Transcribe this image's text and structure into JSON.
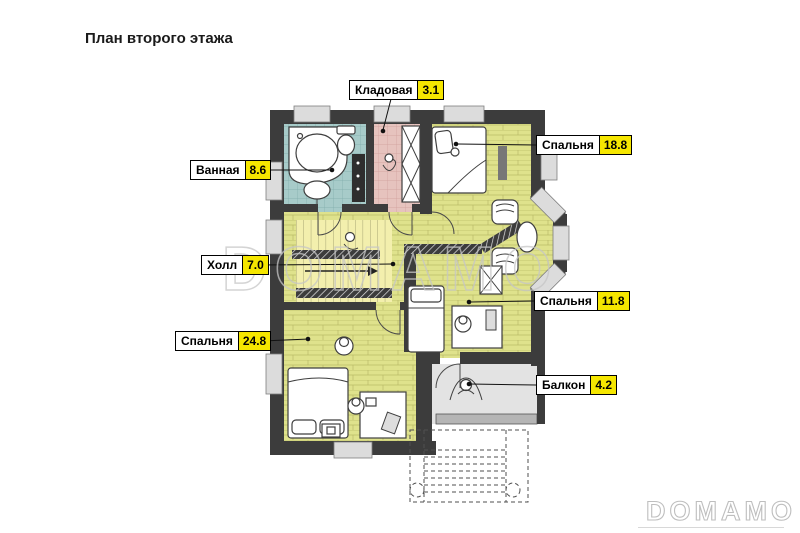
{
  "title": "План второго этажа",
  "watermark": {
    "text": "DOMAMO"
  },
  "rooms": [
    {
      "id": "storage",
      "label": "Кладовая",
      "area": "3.1"
    },
    {
      "id": "bathroom",
      "label": "Ванная",
      "area": "8.6"
    },
    {
      "id": "bedroom-18",
      "label": "Спальня",
      "area": "18.8"
    },
    {
      "id": "hall",
      "label": "Холл",
      "area": "7.0"
    },
    {
      "id": "bedroom-11",
      "label": "Спальня",
      "area": "11.8"
    },
    {
      "id": "bedroom-24",
      "label": "Спальня",
      "area": "24.8"
    },
    {
      "id": "balcony",
      "label": "Балкон",
      "area": "4.2"
    }
  ],
  "colors": {
    "wall": "#3c3c3c",
    "area_badge": "#f5e600",
    "bathroom_floor": "#a7cbc9",
    "storage_floor": "#e6c3be",
    "bedroom_floor": "#dfe28c",
    "stairs_floor": "#f3efad",
    "balcony_floor": "#e3e3e3",
    "watermark": "#c6c6c6"
  }
}
